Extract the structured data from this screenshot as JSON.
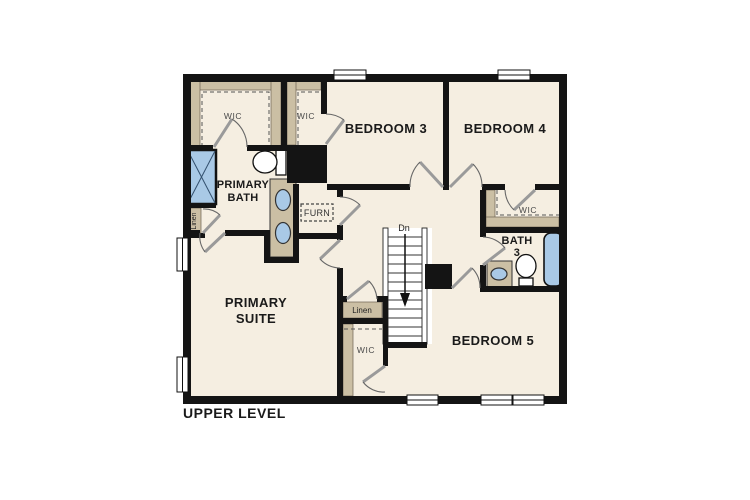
{
  "title": "UPPER LEVEL",
  "floor_plan": {
    "level_label": "UPPER LEVEL",
    "labels": {
      "bedroom3": "BEDROOM 3",
      "bedroom4": "BEDROOM 4",
      "bedroom5": "BEDROOM 5",
      "primary_suite_1": "PRIMARY",
      "primary_suite_2": "SUITE",
      "primary_bath_1": "PRIMARY",
      "primary_bath_2": "BATH",
      "bath3_1": "BATH",
      "bath3_2": "3",
      "wic_primary": "WIC",
      "wic_bedroom3": "WIC",
      "wic_bedroom4": "WIC",
      "wic_bedroom5": "WIC",
      "furnace": "FURN",
      "linen_bath": "Linen",
      "linen_hall": "Linen",
      "stairs_direction": "Dn"
    },
    "colors": {
      "wall": "#141414",
      "floor": "#f5eee1",
      "shelving_tan": "#cbbfa4",
      "fixture_blue": "#a9c9e6",
      "background": "#ffffff"
    }
  }
}
